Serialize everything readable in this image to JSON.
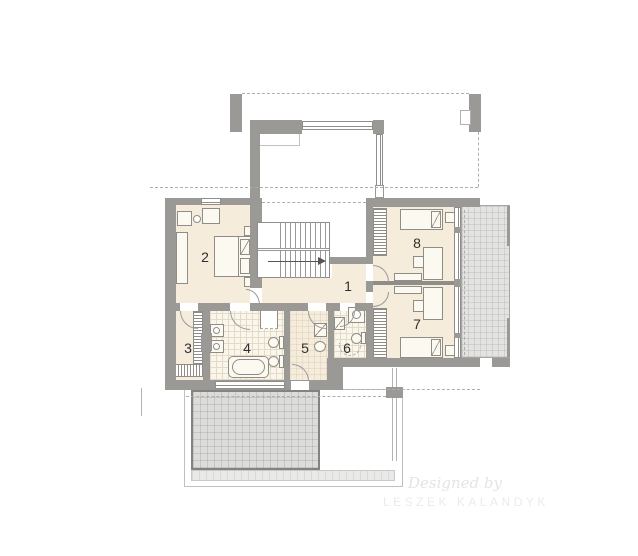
{
  "palette": {
    "wall": "#9b9995",
    "cream": "#f5ecdb",
    "tile": "#faf6ec",
    "tileLine": "#e3dbc6",
    "terrace": "#e3e3e1",
    "terraceS": "#dcdcda",
    "line": "#8f8d85",
    "dash": "#b0aeaa",
    "label": "#2f2f2f",
    "watermark": "#e6e4e0"
  },
  "plan": {
    "rooms": [
      {
        "number": "1"
      },
      {
        "number": "2"
      },
      {
        "number": "3"
      },
      {
        "number": "4"
      },
      {
        "number": "5"
      },
      {
        "number": "6"
      },
      {
        "number": "7"
      },
      {
        "number": "8"
      }
    ]
  },
  "watermark": {
    "line1": "Designed by",
    "line2": "LESZEK KALANDYK"
  }
}
